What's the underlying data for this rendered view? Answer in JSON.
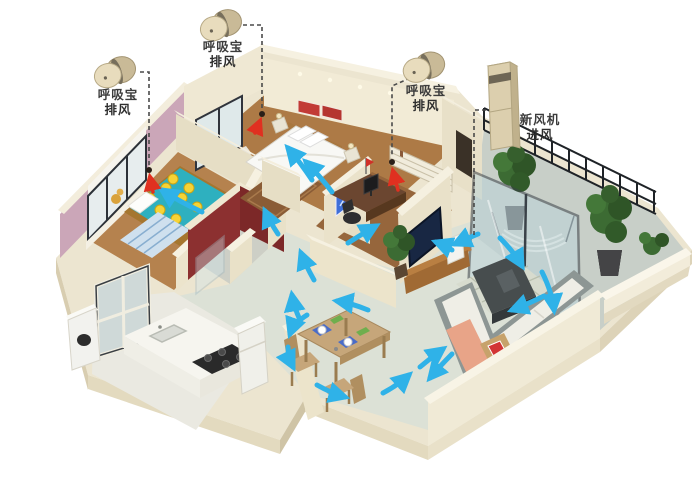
{
  "annotations": {
    "breather_left": {
      "line1": "呼吸宝",
      "line2": "排风"
    },
    "breather_top": {
      "line1": "呼吸宝",
      "line2": "排风"
    },
    "breather_right": {
      "line1": "呼吸宝",
      "line2": "排风"
    },
    "fresh_air": {
      "line1": "新风机",
      "line2": "进风"
    }
  },
  "devices": {
    "exhaust_breather_units": 3,
    "fresh_air_intake_towers": 1
  },
  "colors": {
    "airflow_arrow": "#2fb2e8",
    "exhaust_pointer_arrow": "#e03020",
    "device_shell": "#dccfae",
    "leader_line": "#4a4a4a",
    "background": "#ffffff"
  }
}
